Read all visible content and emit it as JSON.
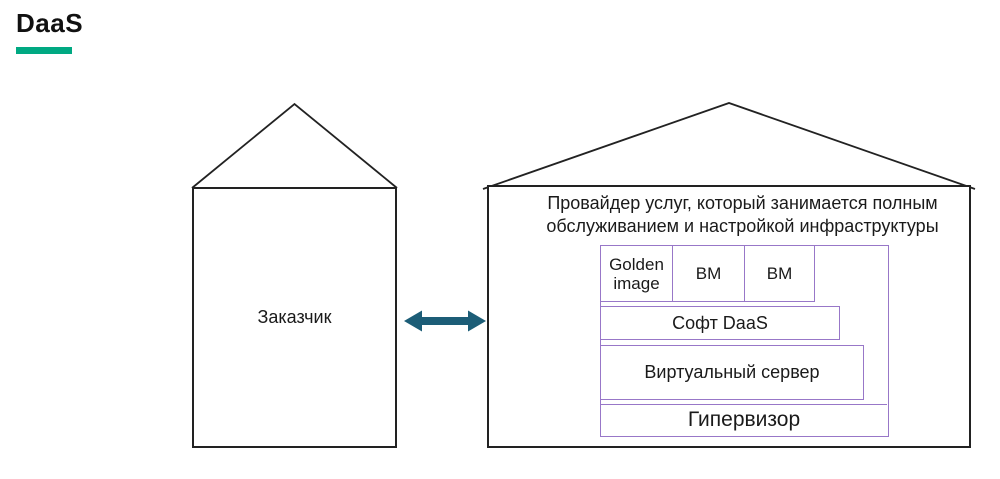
{
  "title": {
    "text": "DaaS"
  },
  "colors": {
    "accent_underline": "#00A982",
    "arrow": "#1C5D77",
    "stack_border": "#9877C8",
    "outline": "#222222"
  },
  "customer": {
    "label": "Заказчик"
  },
  "provider": {
    "description_lines": [
      "Провайдер услуг, который занимается полным",
      "обслуживанием и настройкой инфраструктуры"
    ],
    "stack": {
      "top_row": [
        {
          "label": "Golden image"
        },
        {
          "label": "ВМ"
        },
        {
          "label": "ВМ"
        }
      ],
      "layers": [
        {
          "label": "Софт DaaS"
        },
        {
          "label": "Виртуальный сервер"
        },
        {
          "label": "Гипервизор"
        }
      ]
    }
  }
}
